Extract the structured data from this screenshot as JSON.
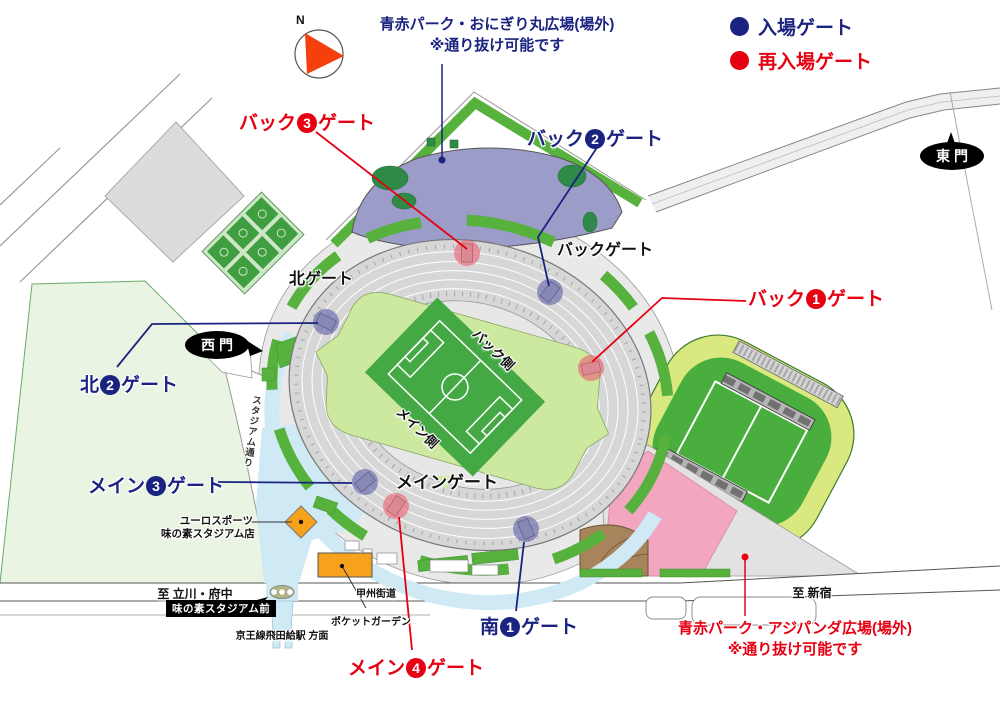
{
  "colors": {
    "entry_navy": "#1b2380",
    "reentry_red": "#e60012",
    "pitch_green": "#44a944",
    "infield_green": "#cde9a0",
    "stands_gray": "#d9d9d9",
    "walkway_cyan": "#cfeaf5",
    "park_purple": "#9c9cc8",
    "plaza_pink": "#f2a6c0",
    "highlight_orange": "#f6a21c"
  },
  "compass": {
    "label": "N"
  },
  "legend": {
    "entry_label": "入場ゲート",
    "reentry_label": "再入場ゲート"
  },
  "notes": {
    "onigiri_line1": "青赤パーク・おにぎり丸広場(場外)",
    "onigiri_line2": "※通り抜け可能です",
    "ajipanda_line1": "青赤パーク・アジパンダ広場(場外)",
    "ajipanda_line2": "※通り抜け可能です"
  },
  "gates": {
    "back1": {
      "prefix": "バック",
      "num": "1",
      "suffix": "ゲート",
      "type": "reentry"
    },
    "back2": {
      "prefix": "バック",
      "num": "2",
      "suffix": "ゲート",
      "type": "entry"
    },
    "back3": {
      "prefix": "バック",
      "num": "3",
      "suffix": "ゲート",
      "type": "reentry"
    },
    "north2": {
      "prefix": "北",
      "num": "2",
      "suffix": "ゲート",
      "type": "entry"
    },
    "main3": {
      "prefix": "メイン",
      "num": "3",
      "suffix": "ゲート",
      "type": "entry"
    },
    "main4": {
      "prefix": "メイン",
      "num": "4",
      "suffix": "ゲート",
      "type": "reentry"
    },
    "south1": {
      "prefix": "南",
      "num": "1",
      "suffix": "ゲート",
      "type": "entry"
    }
  },
  "area_labels": {
    "back_gate": "バックゲート",
    "north_gate": "北ゲート",
    "main_gate": "メインゲート",
    "east_gate": "東門",
    "west_gate": "西門",
    "back_side": "バック側",
    "main_side": "メイン側",
    "stadium_street": "スタジアム通り",
    "koshu_kaido": "甲州街道",
    "to_tachikawa": "至 立川・府中",
    "to_shinjuku": "至 新宿",
    "bus_stop": "味の素スタジアム前",
    "keio_direction": "京王線飛田給駅 方面",
    "pocket_garden": "ポケットガーデン",
    "euro_sports_line1": "ユーロスポーツ",
    "euro_sports_line2": "味の素スタジアム店"
  }
}
